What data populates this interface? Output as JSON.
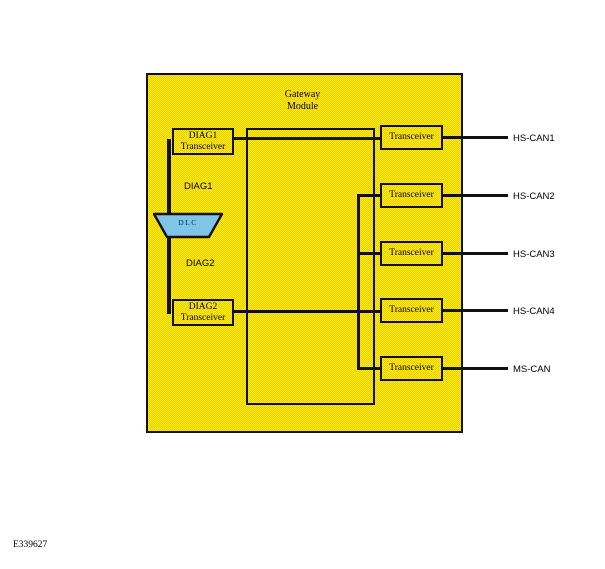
{
  "figure": {
    "id_label": "E339627"
  },
  "module": {
    "title_line1": "Gateway",
    "title_line2": "Module"
  },
  "diag1_box": {
    "line1": "DIAG1",
    "line2": "Transceiver"
  },
  "diag2_box": {
    "line1": "DIAG2",
    "line2": "Transceiver"
  },
  "dlc": {
    "label": "DLC"
  },
  "wires": {
    "diag1": "DIAG1",
    "diag2": "DIAG2"
  },
  "transceivers": [
    "Transceiver",
    "Transceiver",
    "Transceiver",
    "Transceiver",
    "Transceiver"
  ],
  "buses": [
    "HS-CAN1",
    "HS-CAN2",
    "HS-CAN3",
    "HS-CAN4",
    "MS-CAN"
  ],
  "colors": {
    "module_fill_light": "#ffe817",
    "module_fill_dark": "#ecd100",
    "dlc_fill": "#7ec5e8",
    "line": "#111111"
  }
}
